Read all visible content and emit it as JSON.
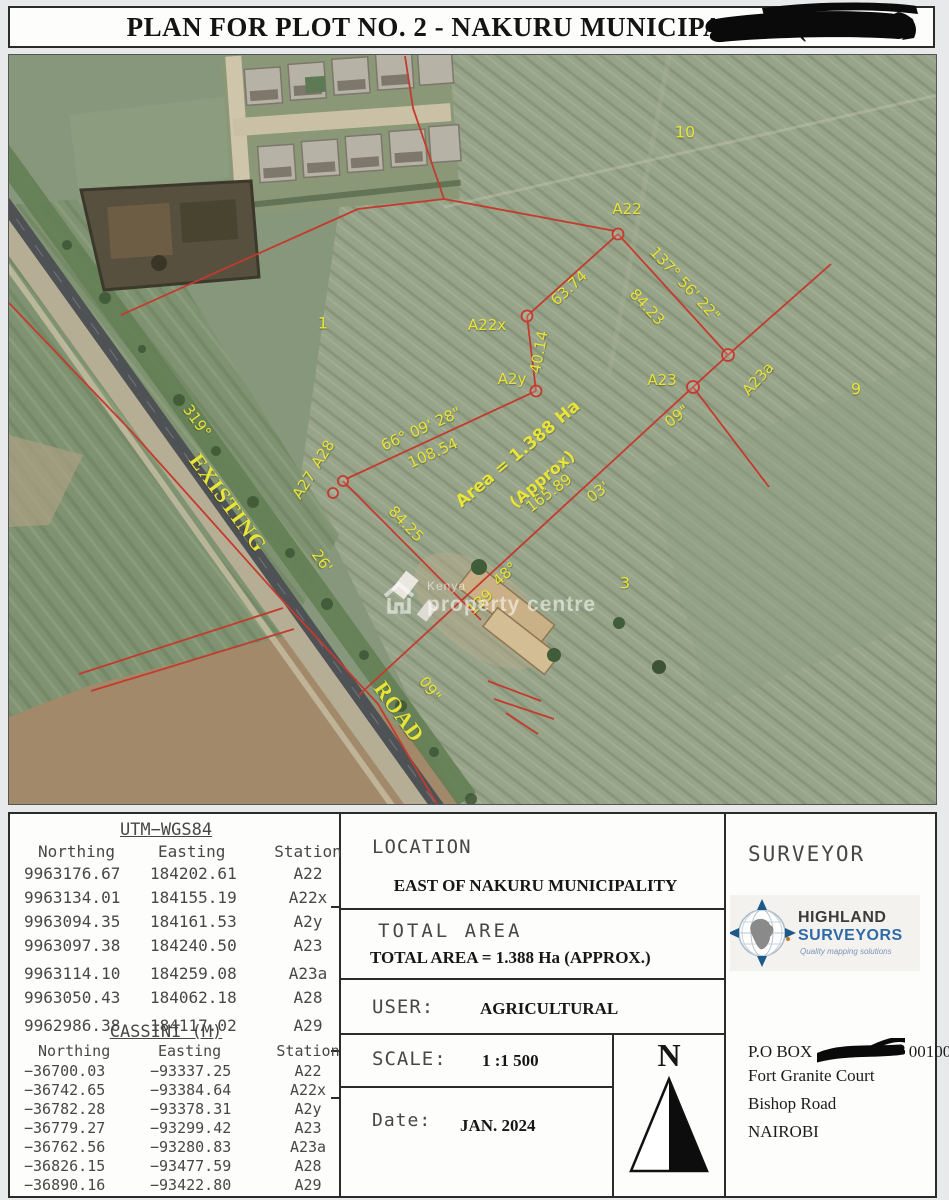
{
  "title": {
    "prefix": "PLAN FOR PLOT NO. 2 - NAKURU MUNICIPALITY (",
    "suffix": ")"
  },
  "map": {
    "watermark": {
      "line1": "Kenya",
      "line2": "property centre"
    },
    "labels": [
      {
        "t": "10",
        "x": 676,
        "y": 77,
        "r": 0,
        "s": 16,
        "c": ""
      },
      {
        "t": "1",
        "x": 314,
        "y": 268,
        "r": 0,
        "s": 16,
        "c": ""
      },
      {
        "t": "9",
        "x": 847,
        "y": 334,
        "r": 0,
        "s": 16,
        "c": ""
      },
      {
        "t": "3",
        "x": 616,
        "y": 528,
        "r": 0,
        "s": 16,
        "c": ""
      },
      {
        "t": "A22",
        "x": 618,
        "y": 154,
        "r": 0,
        "s": 15,
        "c": ""
      },
      {
        "t": "A22x",
        "x": 478,
        "y": 270,
        "r": 0,
        "s": 15,
        "c": ""
      },
      {
        "t": "A2y",
        "x": 503,
        "y": 324,
        "r": 0,
        "s": 15,
        "c": ""
      },
      {
        "t": "A23",
        "x": 653,
        "y": 325,
        "r": 0,
        "s": 15,
        "c": ""
      },
      {
        "t": "A23a",
        "x": 749,
        "y": 324,
        "r": -48,
        "s": 15,
        "c": ""
      },
      {
        "t": "A28",
        "x": 314,
        "y": 399,
        "r": -57,
        "s": 15,
        "c": ""
      },
      {
        "t": "A27",
        "x": 295,
        "y": 430,
        "r": -57,
        "s": 15,
        "c": ""
      },
      {
        "t": "63.74",
        "x": 560,
        "y": 233,
        "r": -43,
        "s": 15,
        "c": ""
      },
      {
        "t": "40.14",
        "x": 530,
        "y": 297,
        "r": -79,
        "s": 15,
        "c": ""
      },
      {
        "t": "137° 56' 22\"",
        "x": 676,
        "y": 229,
        "r": 47,
        "s": 15,
        "c": ""
      },
      {
        "t": "84.23",
        "x": 638,
        "y": 252,
        "r": 47,
        "s": 15,
        "c": ""
      },
      {
        "t": "66° 09' 28\"",
        "x": 412,
        "y": 374,
        "r": -24,
        "s": 15,
        "c": ""
      },
      {
        "t": "108.54",
        "x": 424,
        "y": 398,
        "r": -24,
        "s": 15,
        "c": ""
      },
      {
        "t": "84.25",
        "x": 397,
        "y": 469,
        "r": 46,
        "s": 15,
        "c": ""
      },
      {
        "t": "165.89",
        "x": 540,
        "y": 438,
        "r": -37,
        "s": 15,
        "c": ""
      },
      {
        "t": "03'",
        "x": 589,
        "y": 437,
        "r": -37,
        "s": 15,
        "c": ""
      },
      {
        "t": "09\"",
        "x": 668,
        "y": 361,
        "r": -37,
        "s": 15,
        "c": ""
      },
      {
        "t": "48°",
        "x": 496,
        "y": 519,
        "r": -42,
        "s": 15,
        "c": ""
      },
      {
        "t": "139",
        "x": 471,
        "y": 547,
        "r": -42,
        "s": 15,
        "c": ""
      },
      {
        "t": "319°",
        "x": 188,
        "y": 366,
        "r": 54,
        "s": 15,
        "c": ""
      },
      {
        "t": "26'",
        "x": 313,
        "y": 506,
        "r": 54,
        "s": 15,
        "c": ""
      },
      {
        "t": "09\"",
        "x": 421,
        "y": 634,
        "r": 54,
        "s": 15,
        "c": ""
      },
      {
        "t": "EXISTING",
        "x": 219,
        "y": 448,
        "r": 54,
        "s": 22,
        "c": "serif"
      },
      {
        "t": "ROAD",
        "x": 390,
        "y": 657,
        "r": 54,
        "s": 22,
        "c": "serif"
      },
      {
        "t": "Area = 1.388 Ha",
        "x": 509,
        "y": 399,
        "r": -40,
        "s": 17,
        "c": "bold"
      },
      {
        "t": "(Approx)",
        "x": 533,
        "y": 424,
        "r": -40,
        "s": 16,
        "c": "bold"
      }
    ]
  },
  "panel": {
    "utm": {
      "title": "UTM−WGS84",
      "headers": [
        "Northing",
        "Easting",
        "Station"
      ],
      "rows": [
        [
          "9963176.67",
          "184202.61",
          "A22"
        ],
        [
          "9963134.01",
          "184155.19",
          "A22x"
        ],
        [
          "9963094.35",
          "184161.53",
          "A2y"
        ],
        [
          "9963097.38",
          "184240.50",
          "A23"
        ],
        [
          "9963114.10",
          "184259.08",
          "A23a"
        ],
        [
          "9963050.43",
          "184062.18",
          "A28"
        ],
        [
          "9962986.38",
          "184117.02",
          "A29"
        ]
      ]
    },
    "cassini": {
      "title": "CASSINI (M)",
      "headers": [
        "Northing",
        "Easting",
        "Station"
      ],
      "rows": [
        [
          "−36700.03",
          "−93337.25",
          "A22"
        ],
        [
          "−36742.65",
          "−93384.64",
          "A22x"
        ],
        [
          "−36782.28",
          "−93378.31",
          "A2y"
        ],
        [
          "−36779.27",
          "−93299.42",
          "A23"
        ],
        [
          "−36762.56",
          "−93280.83",
          "A23a"
        ],
        [
          "−36826.15",
          "−93477.59",
          "A28"
        ],
        [
          "−36890.16",
          "−93422.80",
          "A29"
        ]
      ]
    },
    "location": {
      "label": "LOCATION",
      "value": "EAST OF NAKURU MUNICIPALITY"
    },
    "total_area": {
      "label": "TOTAL AREA",
      "value": "TOTAL AREA = 1.388 Ha (APPROX.)"
    },
    "user": {
      "label": "USER:",
      "value": "AGRICULTURAL"
    },
    "scale": {
      "label": "SCALE:",
      "value": "1 :1 500"
    },
    "date": {
      "label": "Date:",
      "value": "JAN. 2024"
    },
    "north": {
      "letter": "N"
    },
    "surveyor": {
      "label": "SURVEYOR",
      "logo": {
        "line1": "HIGHLAND",
        "line2": "SURVEYORS",
        "tagline": "Quality mapping solutions"
      },
      "po_box_prefix": "P.O BOX",
      "po_box_suffix": "00100",
      "address": [
        "Fort Granite Court",
        "Bishop Road",
        "NAIROBI"
      ]
    }
  },
  "colors": {
    "survey_line": "#c43a2e",
    "map_label": "#e8e438",
    "logo_blue": "#2f6aa8",
    "logo_dark": "#3b3b3b"
  }
}
